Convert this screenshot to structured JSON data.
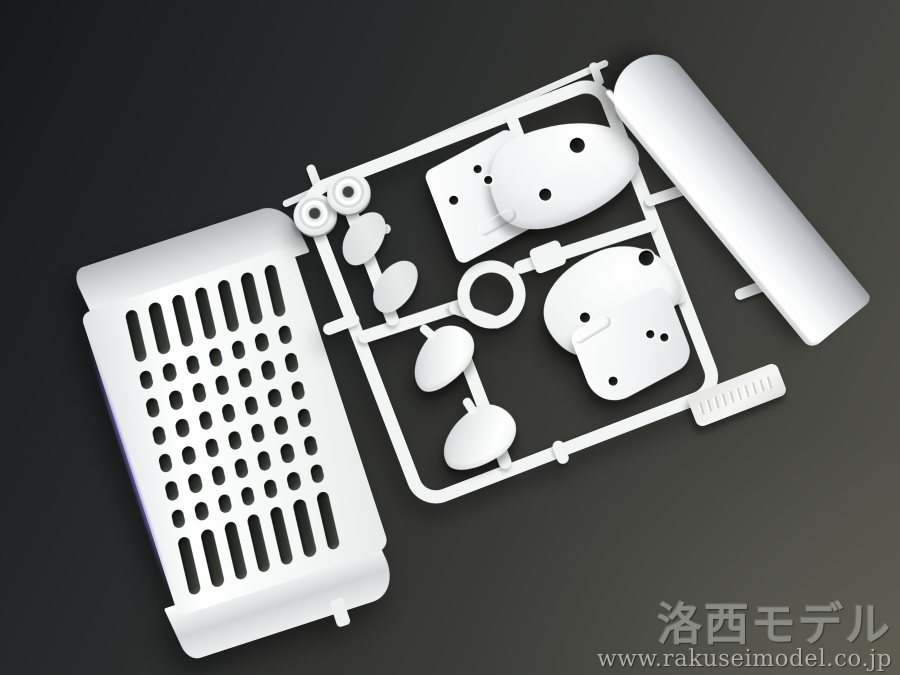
{
  "image": {
    "kind": "product-photograph",
    "subject": "white-plastic-model-kit-sprue-with-parts"
  },
  "watermark": {
    "brand": "洛西モデル",
    "url": "www.rakuseimodel.co.jp"
  },
  "colors": {
    "bg_dark": "#17191a",
    "bg_mid": "#363734",
    "bg_light": "#57574d",
    "plastic": "#f3f4f4",
    "plastic_shade": "#c9cdd0",
    "slot_dark": "#1f211f",
    "violet_edge": "#7c74d2",
    "watermark_brand": "#8f9089",
    "watermark_url": "#b3b3aa"
  },
  "grille": {
    "columns": 7,
    "rows": 8
  },
  "parts": [
    {
      "name": "front-grille-panel"
    },
    {
      "name": "sprue-frame"
    },
    {
      "name": "spoiler-blade"
    },
    {
      "name": "fender-part-upper"
    },
    {
      "name": "fender-part-lower"
    },
    {
      "name": "mirror-housing-upper"
    },
    {
      "name": "mirror-housing-lower"
    },
    {
      "name": "mirror-face-upper"
    },
    {
      "name": "mirror-face-lower"
    },
    {
      "name": "round-cap-left"
    },
    {
      "name": "round-cap-right"
    },
    {
      "name": "center-ring"
    },
    {
      "name": "embossed-brand-tab"
    }
  ]
}
